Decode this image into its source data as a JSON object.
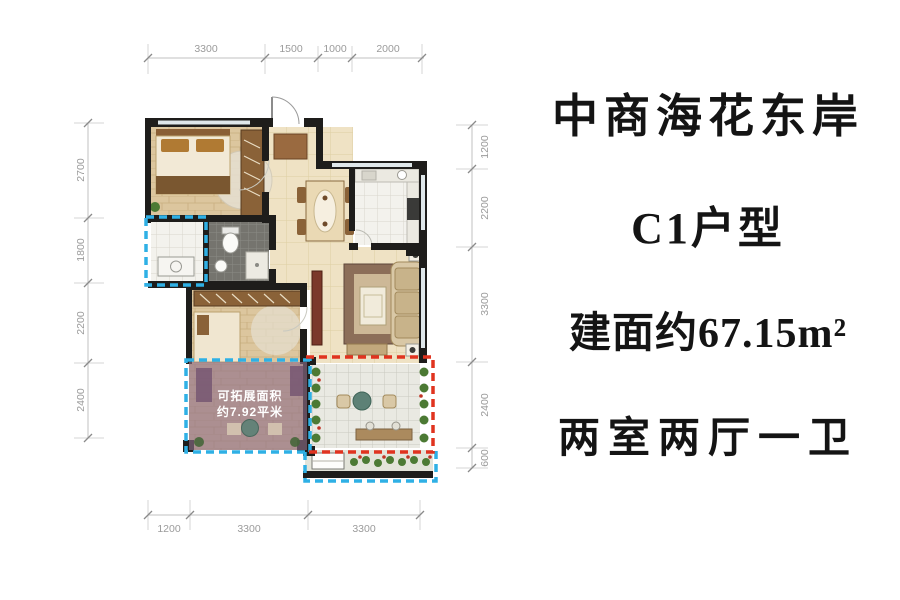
{
  "panel": {
    "title": "中商海花东岸",
    "unit_type": "C1户型",
    "area": "建面约67.15m²",
    "layout": "两室两厅一卫"
  },
  "expand_area": {
    "line1": "可拓展面积",
    "line2": "约7.92平米"
  },
  "dims": {
    "top": [
      "3300",
      "1500",
      "1000",
      "2000"
    ],
    "left": [
      "2700",
      "1800",
      "2200",
      "2400"
    ],
    "right": [
      "1200",
      "2200",
      "3300",
      "2400",
      "600"
    ],
    "bottom": [
      "1200",
      "3300",
      "3300"
    ]
  },
  "colors": {
    "wall": "#1e1d1b",
    "dash_blue": "#2fb0e5",
    "dash_red": "#e0331f",
    "expand_overlay": "#8e6d89",
    "dim_text": "#9b9b9b",
    "dim_line": "#c2c2c2"
  }
}
